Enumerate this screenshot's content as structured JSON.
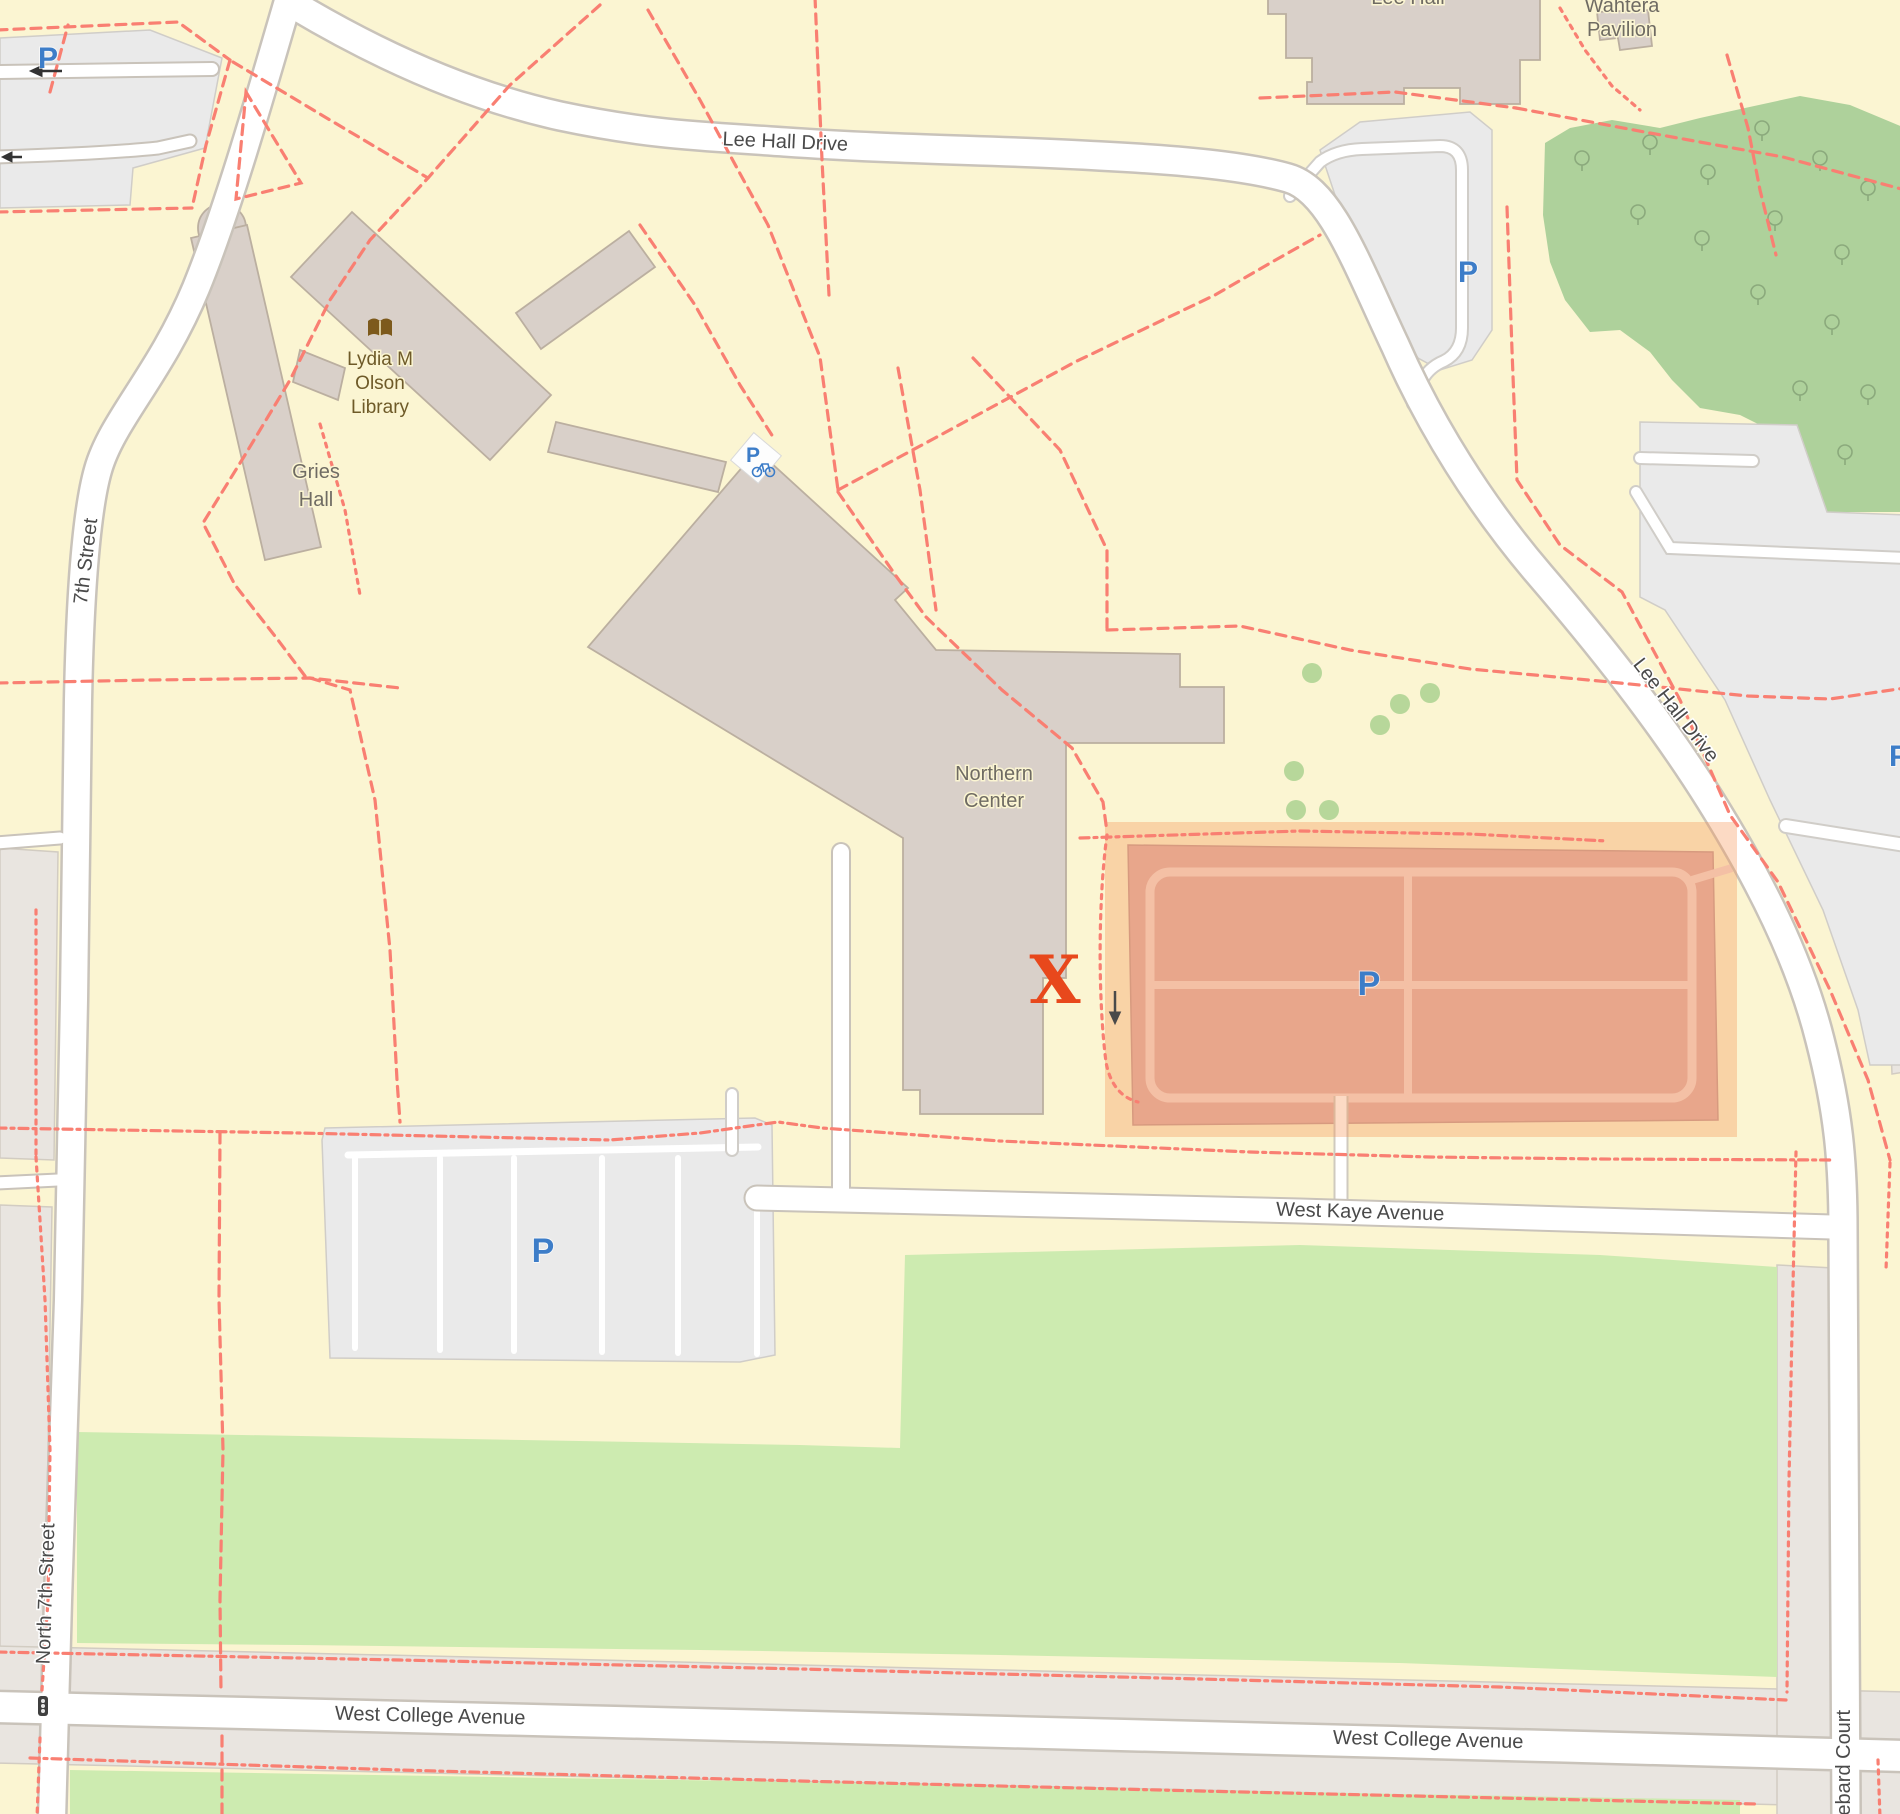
{
  "map": {
    "background": "#fbf5d2",
    "colors": {
      "road_fill": "#ffffff",
      "road_casing": "#c9c3ba",
      "building_fill": "#d9d0c9",
      "building_stroke": "#bbafa0",
      "grass_green": "#cdebb0",
      "forest_green": "#aed19b",
      "parking_gray": "#eaeaea",
      "landuse_gray": "#e9e5e0",
      "footpath_dashed": "#f97f72",
      "highlight_overlay": "rgba(245,150,85,0.35)",
      "highlight_lot_fill": "#e0b0a8",
      "highlight_aisle": "#f3d8d0",
      "parking_blue": "#3d7dc8",
      "marker_orange": "#e8481c"
    },
    "streets": {
      "lee_hall_drive_top": "Lee Hall Drive",
      "lee_hall_drive_diag": "Lee Hall Drive",
      "seventh_street": "7th Street",
      "north_seventh_street": "North 7th Street",
      "west_kaye_avenue": "West Kaye Avenue",
      "west_college_avenue_west": "West College Avenue",
      "west_college_avenue_east": "West College Avenue",
      "hebard_court": "Hebard Court"
    },
    "places": {
      "lee_hall": "Lee Hall",
      "wahtera_pavilion_line1": "Wahtera",
      "wahtera_pavilion_line2": "Pavilion",
      "gries_hall_line1": "Gries",
      "gries_hall_line2": "Hall",
      "olson_library_line1": "Lydia M",
      "olson_library_line2": "Olson",
      "olson_library_line3": "Library",
      "northern_center_line1": "Northern",
      "northern_center_line2": "Center"
    },
    "markers": {
      "x_marker": "X",
      "parking_letter_nw": "P",
      "parking_letter_loop": "P",
      "parking_letter_bike": "P",
      "parking_letter_west": "P",
      "parking_letter_highlight": "P",
      "parking_letter_edge": "P"
    },
    "icons": {
      "book_icon": "open-book (library)",
      "bicycle_parking_icon": "P with bicycle",
      "traffic_signal_icon": "traffic light",
      "oneway_arrow_icon": "one-way arrow",
      "tree_icon": "deciduous tree"
    }
  }
}
